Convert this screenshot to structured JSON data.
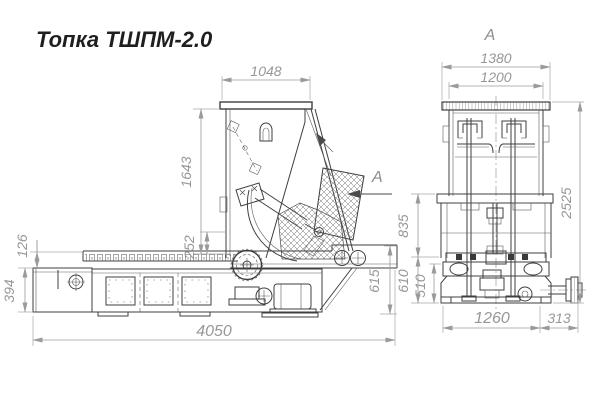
{
  "title": "Топка ТШПМ-2.0",
  "drawing": {
    "side_view": {
      "view_arrow_label": "A",
      "dims": {
        "hopper_width": "1048",
        "hopper_height": "1643",
        "throat_height": "252",
        "chain_offset": "126",
        "ash_box_height": "394",
        "total_length": "4050",
        "conveyor_height": "615"
      }
    },
    "front_view": {
      "label": "A",
      "dims": {
        "rim_width": "1380",
        "body_width": "1200",
        "total_height": "2525",
        "frame_height": "835",
        "beam_height": "610",
        "base_height": "510",
        "base_width": "1260",
        "shaft_extension": "313"
      }
    }
  }
}
